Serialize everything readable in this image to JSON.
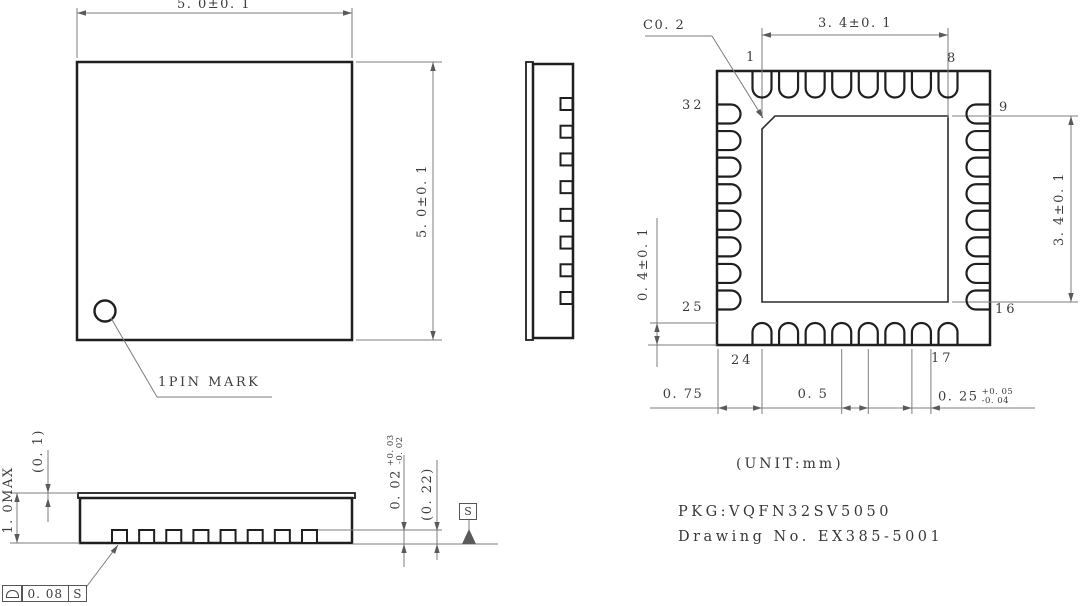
{
  "drawing": {
    "unit_note": "(UNIT:mm)",
    "pkg_label": "PKG:VQFN32SV5050",
    "drawing_no": "Drawing No. EX385-5001"
  },
  "package": {
    "total_pins": 32,
    "pins_per_side": 8
  },
  "top_view": {
    "width_dim": "5. 0±0. 1",
    "height_dim": "5. 0±0. 1",
    "pin_mark_label": "1PIN MARK"
  },
  "bottom_view": {
    "chamfer_dim": "C0. 2",
    "epad_width_dim": "3. 4±0. 1",
    "epad_height_dim": "3. 4±0. 1",
    "terminal_length_dim": "0. 4±0. 1",
    "corner_to_pin_dim": "0. 75",
    "pin_pitch_dim": "0. 5",
    "terminal_width_dim": "0. 25",
    "terminal_width_tol_plus": "+0. 05",
    "terminal_width_tol_minus": "-0. 04",
    "pin_labels": {
      "p1": "1",
      "p8": "8",
      "p9": "9",
      "p16": "16",
      "p17": "17",
      "p24": "24",
      "p25": "25",
      "p32": "32"
    }
  },
  "section_view": {
    "overall_height_dim": "1. 0MAX",
    "cap_thickness_dim": "(0. 1)",
    "standoff_dim": "0. 02",
    "standoff_tol_plus": "+0. 03",
    "standoff_tol_minus": "-0. 02",
    "terminal_thickness_dim": "(0. 22)",
    "datum_label": "S",
    "flatness_symbol": "⌓",
    "flatness_value": "0. 08",
    "flatness_datum": "S"
  },
  "colors": {
    "line": "#1f1f1f",
    "dim_line": "#7d7d7d",
    "text": "#3c3c3c",
    "background": "#ffffff"
  }
}
